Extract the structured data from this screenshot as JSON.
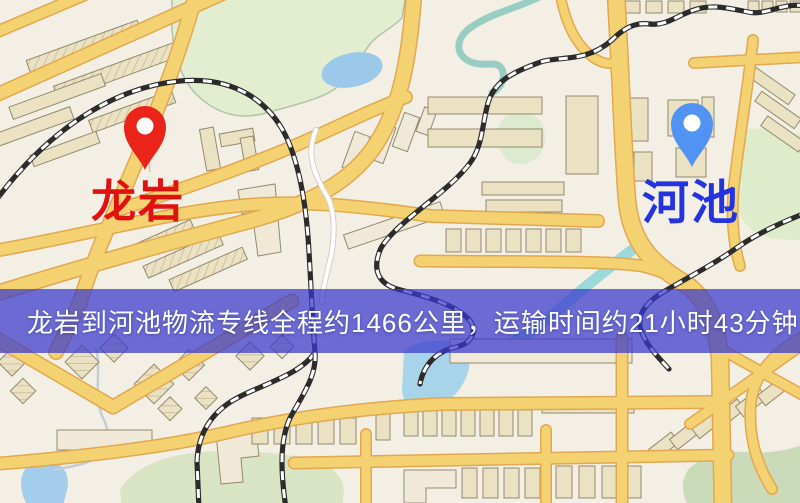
{
  "banner": {
    "text": "龙岩到河池物流专线全程约1466公里，运输时间约21小时43分钟.",
    "background_rgba": "rgba(58,58,205,0.73)",
    "text_color": "#ffffff"
  },
  "markers": {
    "origin": {
      "label": "龙岩",
      "color": "#ea2419",
      "label_color": "#e31010"
    },
    "destination": {
      "label": "河池",
      "color": "#5193f2",
      "label_color": "#2433dd"
    }
  },
  "route": {
    "origin": "龙岩",
    "destination": "河池",
    "distance_text": "约1466公里",
    "duration_text": "约21小时43分钟"
  },
  "map_palette": {
    "background": "#f4efe5",
    "road_fill": "#f5d271",
    "road_casing": "#e0a850",
    "building": "#ebe1c3",
    "park_green": "#d9e4c4",
    "water_blue": "#9cc9e9",
    "river_teal": "#8fc9c0",
    "railway": "#2b2b2b"
  }
}
